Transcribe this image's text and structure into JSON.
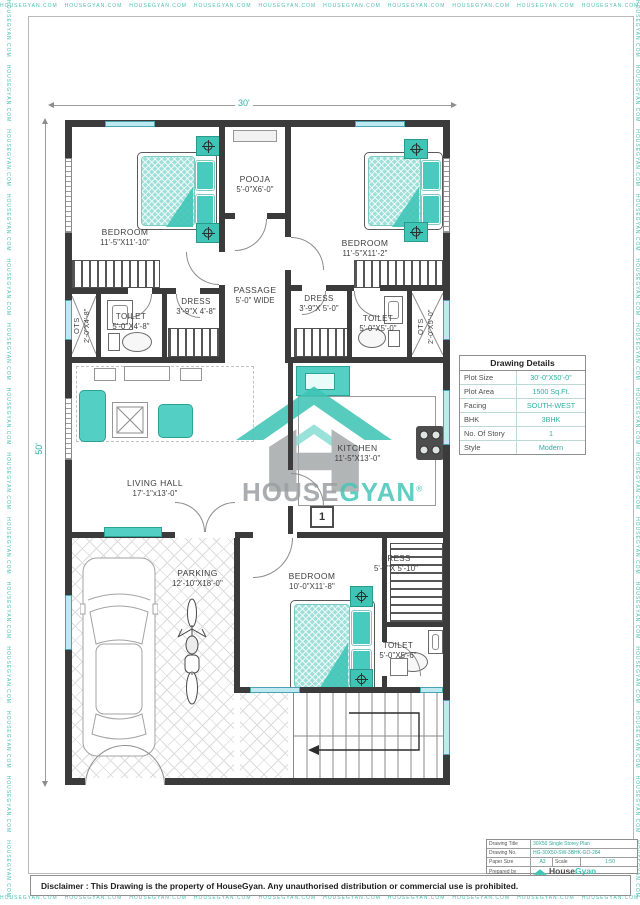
{
  "watermark": {
    "text": "HOUSEGYAN.COM"
  },
  "plan": {
    "dim_top": "30'",
    "dim_left": "50'",
    "marker_1": "1",
    "rooms": [
      {
        "name": "BEDROOM",
        "dims": "11'-5\"X11'-10\""
      },
      {
        "name": "POOJA",
        "dims": "5'-0\"X6'-0\""
      },
      {
        "name": "BEDROOM",
        "dims": "11'-5\"X11'-2\""
      },
      {
        "name": "PASSAGE",
        "dims": "5'-0\" WIDE"
      },
      {
        "name": "TOILET",
        "dims": "5'-0\"X4'-8\""
      },
      {
        "name": "DRESS",
        "dims": "3'-9\"X 4'-8\""
      },
      {
        "name": "OTS",
        "dims": "2'-0\"X4'-8\""
      },
      {
        "name": "DRESS",
        "dims": "3'-9\"X 5'-0\""
      },
      {
        "name": "TOILET",
        "dims": "5'-0\"X5'-0\""
      },
      {
        "name": "OTS",
        "dims": "2'-0\"X5'-0\""
      },
      {
        "name": "LIVING HALL",
        "dims": "17'-1\"x13'-0\""
      },
      {
        "name": "KITCHEN",
        "dims": "11'-5\"X13'-0\""
      },
      {
        "name": "PARKING",
        "dims": "12'-10\"X18'-0\""
      },
      {
        "name": "BEDROOM",
        "dims": "10'-0\"X11'-8\""
      },
      {
        "name": "DRESS",
        "dims": "5'-0\"X 5'-10\""
      },
      {
        "name": "TOILET",
        "dims": "5'-0\"X5'-6\""
      }
    ]
  },
  "watermark_logo": {
    "house": "HOUSE",
    "gyan": "GYAN",
    "reg": "®"
  },
  "drawing_details": {
    "title": "Drawing Details",
    "rows": [
      {
        "label": "Plot Size",
        "value": "30'-0\"X50'-0\""
      },
      {
        "label": "Plot Area",
        "value": "1500 Sq.Ft."
      },
      {
        "label": "Facing",
        "value": "SOUTH-WEST"
      },
      {
        "label": "BHK",
        "value": "3BHK"
      },
      {
        "label": "No. Of Story",
        "value": "1"
      },
      {
        "label": "Style",
        "value": "Modern"
      }
    ]
  },
  "title_block": {
    "drawing_title_label": "Drawing Title",
    "drawing_title": "30X50 Single Storey Plan",
    "drawing_no_label": "Drawing No.",
    "drawing_no": "HG-30X50-SW-3BHK-GO-284",
    "paper_size_label": "Paper Size",
    "paper_size": "A3",
    "scale_label": "Scale",
    "scale": "1:50",
    "prepared_by_label": "Prepared by",
    "prepared_by": "AYUSHI",
    "logo_house": "House",
    "logo_gyan": "Gyan",
    "tagline1": "We make simple and affordable",
    "tagline2": "www.housegyan.com"
  },
  "disclaimer": "Disclaimer : This Drawing is the property of HouseGyan. Any unauthorised distribution or commercial use is prohibited."
}
